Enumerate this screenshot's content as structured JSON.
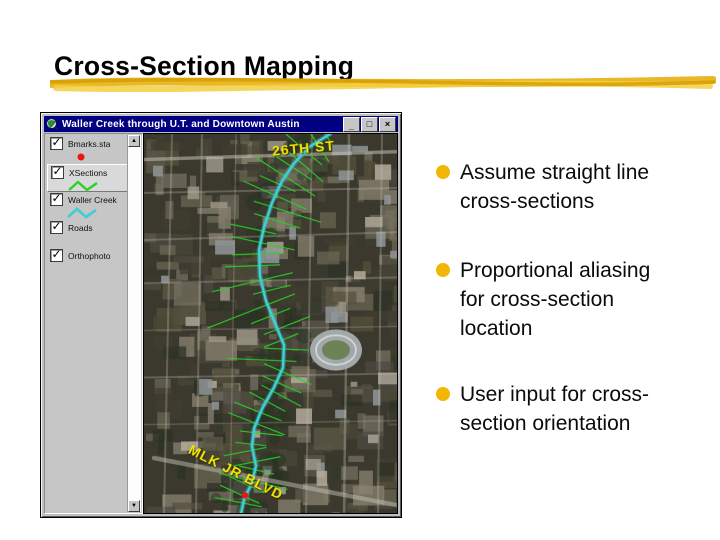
{
  "slide": {
    "title": "Cross-Section Mapping",
    "title_color": "#000000",
    "marker_color": "#e7b41c",
    "bullet_color": "#f2b705",
    "bullets": [
      "Assume straight line\ncross-sections",
      "Proportional aliasing\nfor cross-section\nlocation",
      "User input for cross-\nsection orientation"
    ]
  },
  "window": {
    "title": "Waller Creek through U.T. and Downtown Austin",
    "controls": [
      {
        "name": "minimize",
        "glyph": "_"
      },
      {
        "name": "maximize",
        "glyph": "□"
      },
      {
        "name": "close",
        "glyph": "×"
      }
    ],
    "legend": {
      "items": [
        {
          "label": "Bmarks.sta",
          "checked": "✓",
          "symbol": "red-dot",
          "active": false
        },
        {
          "label": "XSections",
          "checked": "✓",
          "symbol": "green-zigzag",
          "active": true
        },
        {
          "label": "Waller Creek",
          "checked": "✓",
          "symbol": "cyan-zigzag",
          "active": false
        },
        {
          "label": "Roads",
          "checked": "✓",
          "symbol": "none",
          "active": false
        },
        {
          "label": "Orthophoto",
          "checked": "✓",
          "symbol": "none",
          "active": false
        }
      ],
      "scrollbar": {
        "up": "▲",
        "down": "▼"
      }
    },
    "map": {
      "street_labels": [
        "26TH ST",
        "MLK JR BLVD"
      ],
      "colors": {
        "creek": "#3fd0d4",
        "cross_section": "#27d427",
        "street_label": "#f2e400",
        "marker_dot": "#ee1212"
      }
    }
  }
}
